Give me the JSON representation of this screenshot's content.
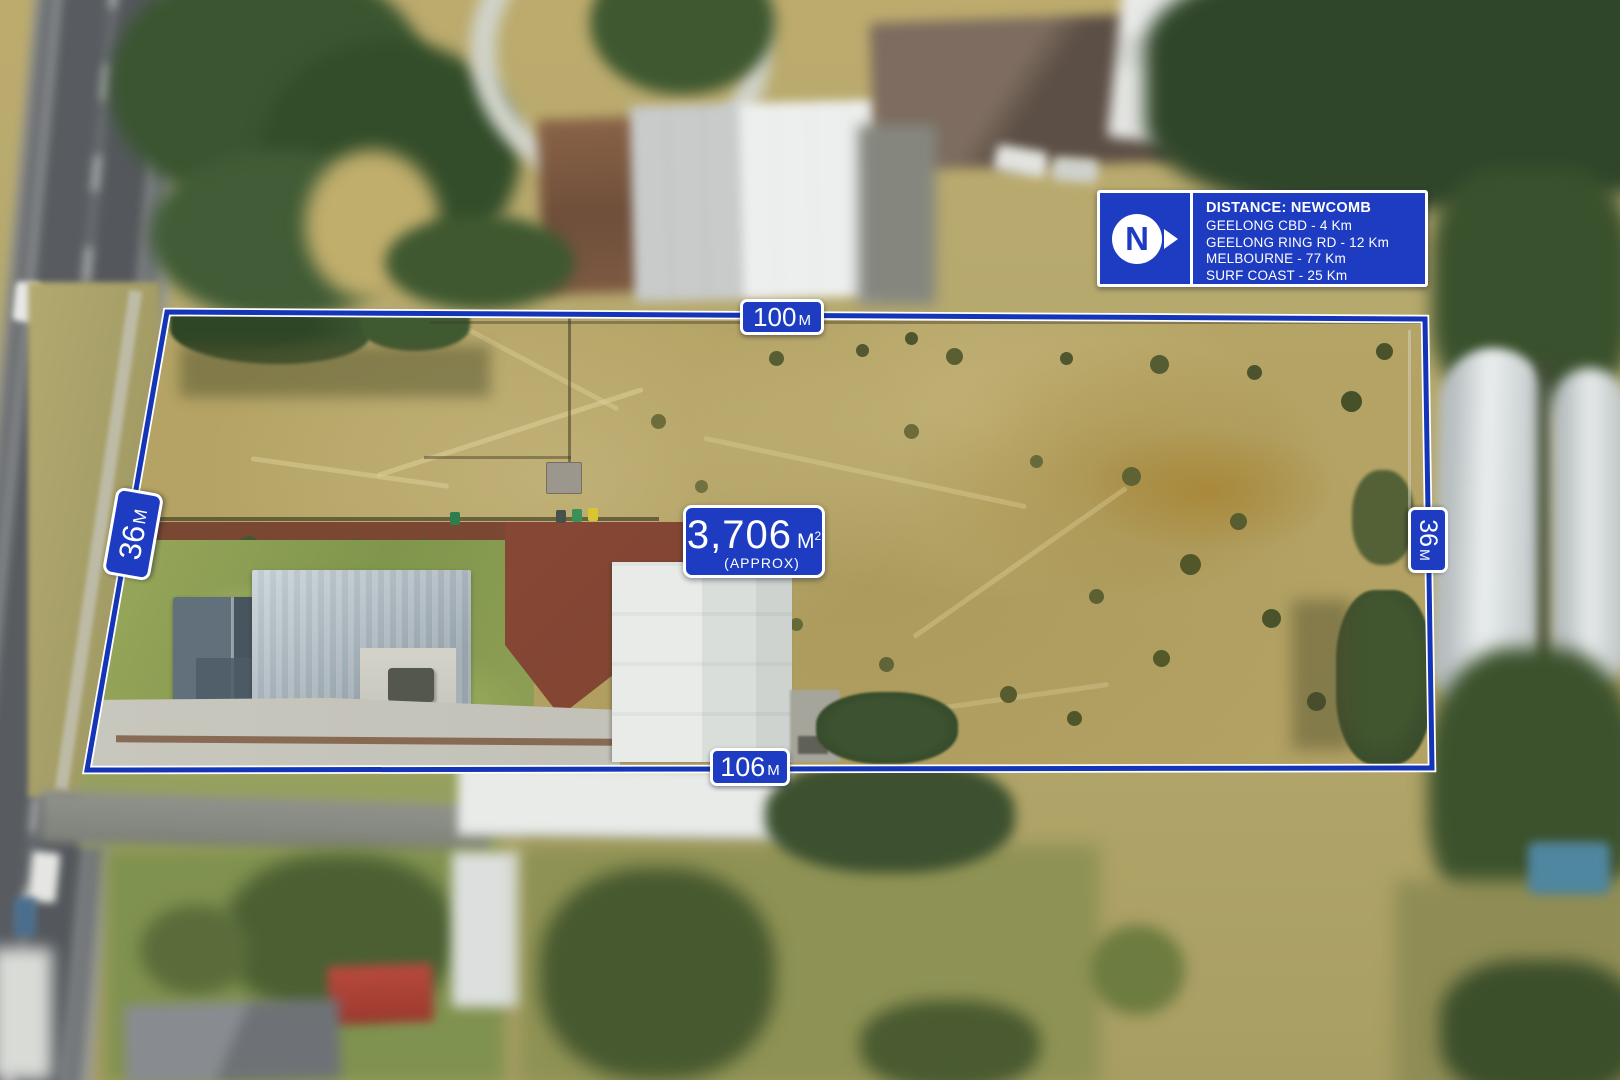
{
  "annotations": {
    "dimensions": {
      "top": {
        "value": "100",
        "unit": "M"
      },
      "bottom": {
        "value": "106",
        "unit": "M"
      },
      "left": {
        "value": "36",
        "unit": "M"
      },
      "right": {
        "value": "36",
        "unit": "M"
      }
    },
    "area_label": {
      "value": "3,706",
      "unit_base": "M",
      "unit_sup": "2",
      "qualifier": "(APPROX)"
    },
    "distance_panel": {
      "logo_letter": "N",
      "title": "DISTANCE: NEWCOMB",
      "items": [
        "GEELONG CBD - 4 Km",
        "GEELONG RING RD - 12 Km",
        "MELBOURNE - 77 Km",
        "SURF COAST - 25 Km"
      ]
    },
    "colors": {
      "panel_blue": "#1d3cc2",
      "boundary_blue": "#1535b8",
      "outline_white": "#ffffff"
    }
  }
}
